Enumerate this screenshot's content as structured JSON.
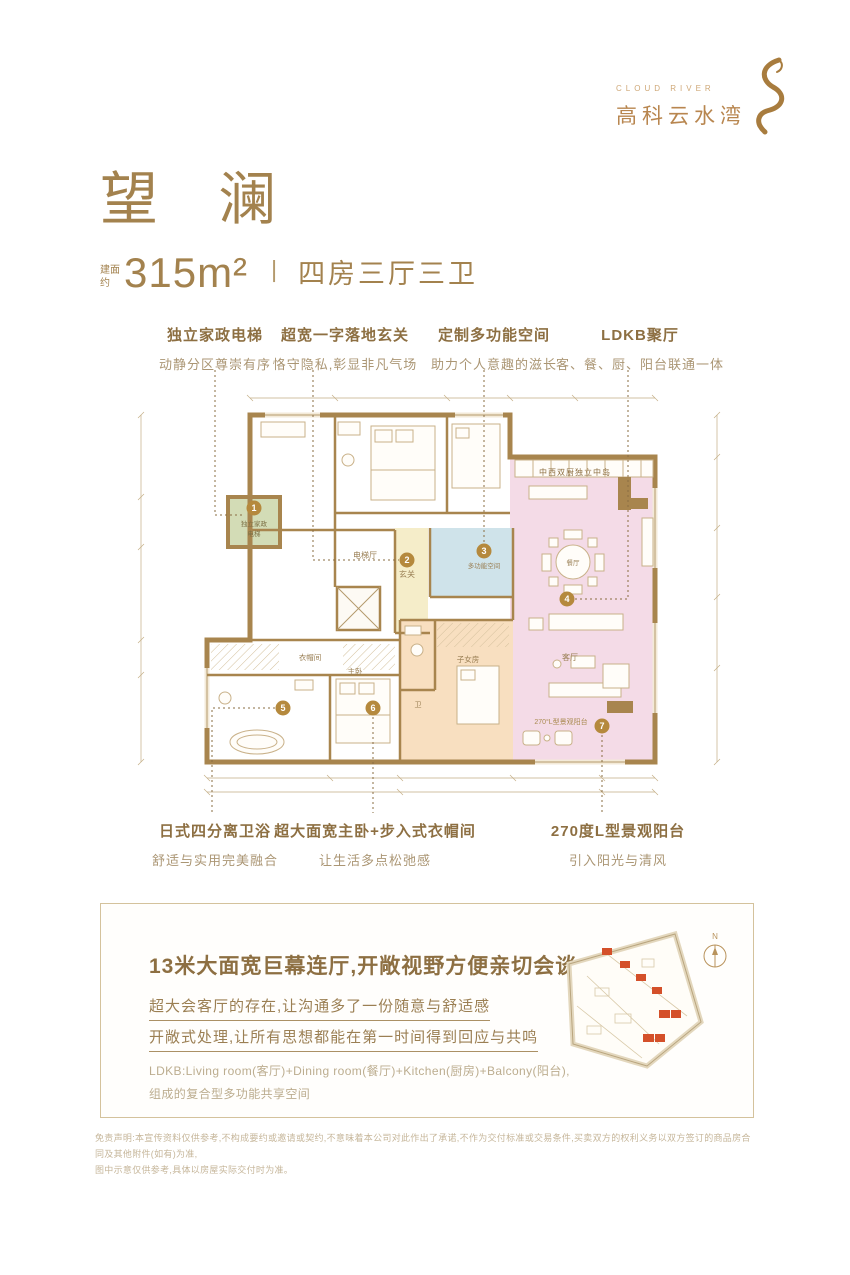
{
  "brand": {
    "english": "CLOUD RIVER",
    "name": "高科云水湾"
  },
  "header": {
    "title": "望 澜",
    "area_prefix": "建面约",
    "area": "315m²",
    "separator": "丨",
    "rooms": "四房三厅三卫"
  },
  "callouts_top": [
    {
      "title": "独立家政电梯",
      "subtitle": "动静分区尊崇有序"
    },
    {
      "title": "超宽一字落地玄关",
      "subtitle": "恪守隐私,彰显非凡气场"
    },
    {
      "title": "定制多功能空间",
      "subtitle": "助力个人意趣的滋长"
    },
    {
      "title": "LDKB聚厅",
      "subtitle": "客、餐、厨、阳台联通一体"
    }
  ],
  "callouts_bottom": [
    {
      "title": "日式四分离卫浴",
      "subtitle": "舒适与实用完美融合"
    },
    {
      "title": "超大面宽主卧+步入式衣帽间",
      "subtitle": "让生活多点松弛感"
    },
    {
      "title": "270度L型景观阳台",
      "subtitle": "引入阳光与清风"
    }
  ],
  "floorplan": {
    "markers": [
      "1",
      "2",
      "3",
      "4",
      "5",
      "6",
      "7"
    ],
    "labels": {
      "service_elevator_line1": "独立家政",
      "service_elevator_line2": "电梯",
      "elevator_hall": "电梯厅",
      "foyer": "玄关",
      "multi_room": "多功能空间",
      "kitchen_island": "中西双厨独立中岛",
      "dining": "餐厅",
      "living": "客厅",
      "closet": "衣帽间",
      "master": "主卧",
      "kids": "子女房",
      "bath": "卫",
      "balcony": "270°L型景观阳台"
    },
    "colors": {
      "wall": "#a8854e",
      "pink": "#f4dbe7",
      "green": "#d3dcb6",
      "blue": "#cfe3ea",
      "yellow": "#f5edc9",
      "orange": "#f8dfc0",
      "marker": "#b5893d"
    }
  },
  "feature_box": {
    "title": "13米大面宽巨幕连厅,开敞视野方便亲切会谈",
    "underlined_lines": [
      "超大会客厅的存在,让沟通多了一份随意与舒适感",
      "开敞式处理,让所有思想都能在第一时间得到回应与共鸣"
    ],
    "notes": [
      "LDKB:Living room(客厅)+Dining room(餐厅)+Kitchen(厨房)+Balcony(阳台),",
      "组成的复合型多功能共享空间"
    ],
    "compass_label": "N"
  },
  "disclaimer": {
    "line1": "免责声明:本宣传资料仅供参考,不构成要约或邀请或契约,不意味着本公司对此作出了承诺,不作为交付标准或交易条件,买卖双方的权利义务以双方签订的商品房合同及其他附件(如有)为准,",
    "line2": "图中示意仅供参考,具体以房屋实际交付时为准。"
  }
}
